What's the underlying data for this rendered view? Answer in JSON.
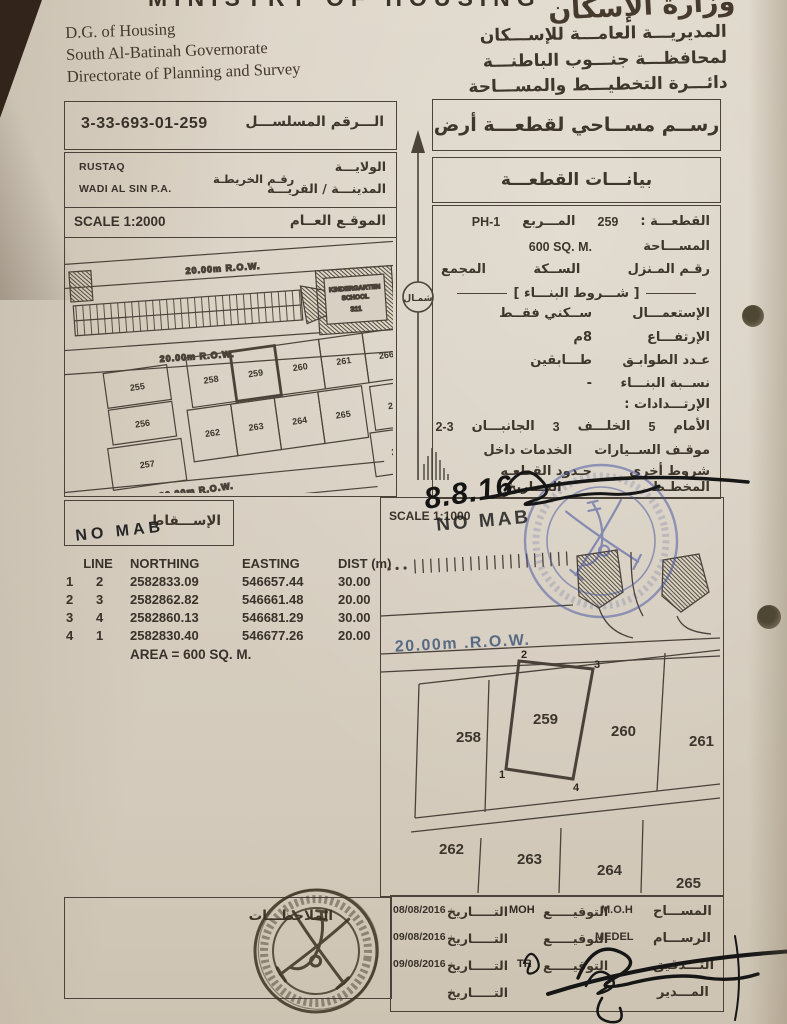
{
  "header": {
    "ministry_cut": "MINISTRY  OF  HOUSING",
    "calligraphy": "وزارة الإسكان",
    "en_lines": [
      "D.G. of Housing",
      "South Al-Batinah Governorate",
      "Directorate of Planning and Survey"
    ],
    "ar_lines": [
      "المديريـــة العامـــة للإســـكان",
      "لمحافظـــة جنـــوب الباطنـــة",
      "دائـــرة التخطيـــط والمســـاحة"
    ]
  },
  "serial_box": {
    "label": "الـــرقم المسلســـل",
    "value": "3-33-693-01-259"
  },
  "title_box": {
    "text": "رســم مســاحي لقطعـــة أرض"
  },
  "admin_box": {
    "wilaya_value": "RUSTAQ",
    "wilaya_label": "الولايـــة",
    "map_no_label": "رقـم الخريطـة",
    "town_value": "WADI AL SIN P.A.",
    "town_label": "المدينـــة / القريـــة"
  },
  "data_header_box": {
    "text": "بيانـــات القطعـــة"
  },
  "north_arrow": {
    "label": "شمـال"
  },
  "general_map": {
    "scale": "SCALE 1:2000",
    "title": "الموقـع العــام",
    "road1": "20.00m  R.O.W.",
    "road2": "20.00m  R.O.W.",
    "road3": "20.00m  R.O.W.",
    "school_line1": "KINDERGARTEN",
    "school_line2": "SCHOOL",
    "school_no": "311",
    "plots": {
      "left_col": [
        "255",
        "256",
        "257"
      ],
      "row1": [
        "258",
        "259",
        "260",
        "261"
      ],
      "row2": [
        "262",
        "263",
        "264",
        "265"
      ],
      "right_col": [
        "266",
        "267",
        "268"
      ]
    },
    "subject": "259"
  },
  "plot_data": {
    "plot_label": "القطعـــة :",
    "plot_value": "259",
    "square_label": "المـــربع",
    "square_value": "PH-1",
    "area_label": "المســـاحة",
    "area_value": "600 SQ. M.",
    "house_no_label": "رقـم المـنزل",
    "lane_label": "الســكة",
    "complex_label": "المجمع",
    "conditions_title": "شـــروط البنـــاء",
    "use_label": "الإستعمـــال",
    "use_value": "ســكني فقــط",
    "height_label": "الإرتفـــاع",
    "height_value": "8م",
    "floors_label": "عـدد الطوابـق",
    "floors_value": "طـــابقين",
    "ratio_label": "نســبة البنـــاء",
    "ratio_value": "-",
    "setbacks_label": "الإرتـــدادات :",
    "front_label": "الأمام",
    "front_value": "5",
    "back_label": "الخلـــف",
    "back_value": "3",
    "sides_label": "الجانبـــان",
    "sides_value": "2-3",
    "parking_label": "موقـف الســيارات",
    "parking_value": "الخدمات داخل",
    "other_label": "شروط أخرى",
    "other_value": "حـدود القطعـه",
    "planner_label": "المخطـط",
    "planner_date_label": "التـــاريخ"
  },
  "projection_box": {
    "label": "الإســـقاط",
    "handwritten": "NO MAB"
  },
  "coords_table": {
    "headers": [
      "LINE",
      "NORTHING",
      "EASTING",
      "DIST (m)"
    ],
    "rows": [
      [
        "1",
        "2",
        "2582833.09",
        "546657.44",
        "30.00"
      ],
      [
        "2",
        "3",
        "2582862.82",
        "546661.48",
        "20.00"
      ],
      [
        "3",
        "4",
        "2582860.13",
        "546681.29",
        "30.00"
      ],
      [
        "4",
        "1",
        "2582830.40",
        "546677.26",
        "20.00"
      ]
    ],
    "area_line": "AREA = 600 SQ. M."
  },
  "detail_map": {
    "scale": "SCALE 1:1000",
    "handwritten_no_mab": "NO MAB",
    "handwritten_date": "8.8.16",
    "road_label": "20.00m .R.O.W.",
    "plots_row1": [
      "258",
      "259",
      "260",
      "261"
    ],
    "plots_row2": [
      "262",
      "263",
      "264",
      "265"
    ],
    "subject": "259",
    "corner_labels": {
      "tl": "2",
      "tr": "3",
      "bl": "1",
      "br": "4"
    }
  },
  "notes_box": {
    "label": "الملاحظـــات"
  },
  "signature_table": {
    "rows": [
      {
        "role": "المســـاح",
        "name": "M.O.H",
        "sig_label": "التوقيـــــع",
        "sig_value": "MOH",
        "date_label": "التـــــاريخ",
        "date": "08/08/2016"
      },
      {
        "role": "الرســـام",
        "name": "MEDEL",
        "sig_label": "التوقيـــــع",
        "sig_value": "",
        "date_label": "التـــــاريخ",
        "date": "09/08/2016"
      },
      {
        "role": "التـــدقيق",
        "name": "",
        "sig_label": "التوقيـــــع",
        "sig_value": "TR",
        "date_label": "التـــــاريخ",
        "date": "09/08/2016"
      },
      {
        "role": "المـــدير",
        "name": "",
        "sig_label": "",
        "sig_value": "",
        "date_label": "التـــــاريخ",
        "date": ""
      }
    ]
  },
  "colors": {
    "paper": "#d8d0c2",
    "ink_line": "#4b4339",
    "stamp_blue": "#3f4f9f",
    "stamp_dark": "#3b3322",
    "background": "#32241a"
  }
}
